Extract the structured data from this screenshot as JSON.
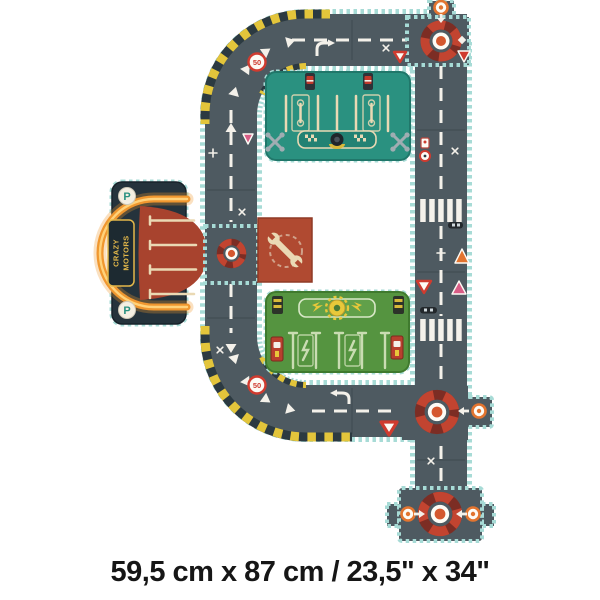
{
  "caption": "59,5 cm x 87 cm / 23,5\" x 34\"",
  "brand": {
    "line1": "CRAZY",
    "line2": "MOTORS"
  },
  "signs": {
    "speed_limit": "50",
    "parking": "P"
  },
  "colors": {
    "background": "#ffffff",
    "road": "#4e5a61",
    "road_edge": "#a7dbd6",
    "marking": "#f4f1ea",
    "seam": "#39444b",
    "hazard_yellow": "#e3c53b",
    "hazard_dark": "#2c3a41",
    "building_teal": "#2a9180",
    "building_teal_dark": "#20776a",
    "building_green": "#559440",
    "building_green_dark": "#3f7a2e",
    "apron_red": "#a8432e",
    "navy": "#25333c",
    "neon_orange": "#f0972f",
    "neon_light": "#ffd27a",
    "cream": "#ead9b4",
    "roundabout_dark": "#7c2d24",
    "roundabout_red": "#c24430",
    "roundabout_center": "#d4572e",
    "sign_red": "#cf3b2f",
    "sign_pink": "#d95d86",
    "sign_orange": "#e2742f",
    "wrench_sign_bg": "#b04a31",
    "gold": "#e3b84a",
    "caption_text": "#161616"
  }
}
